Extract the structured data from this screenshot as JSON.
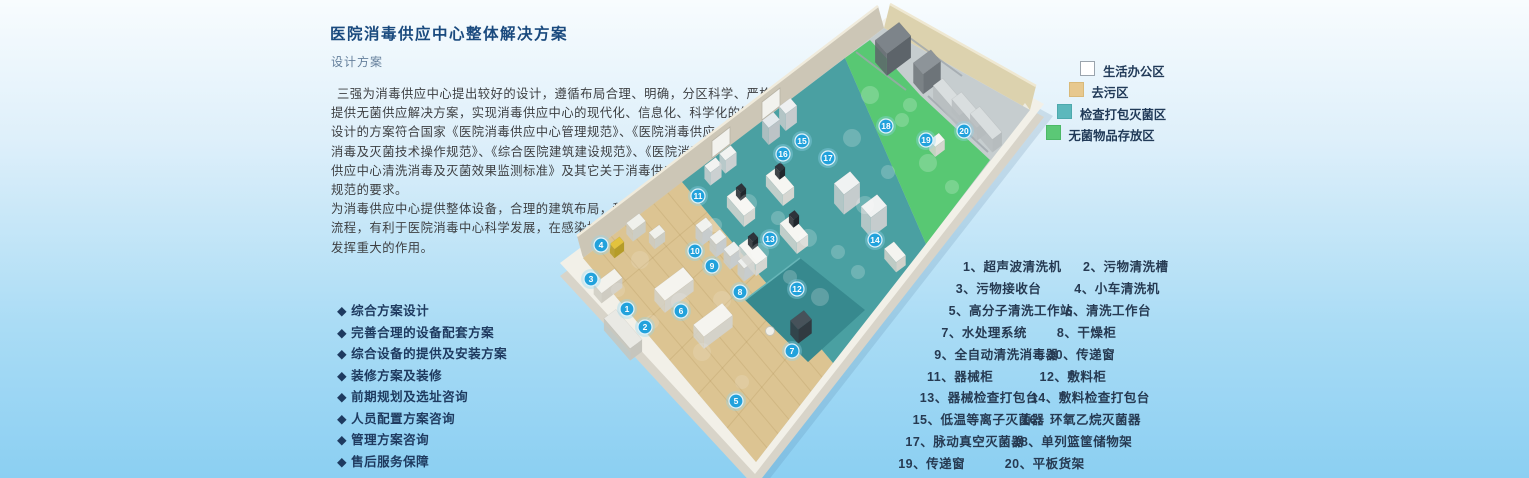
{
  "header": {
    "title": "医院消毒供应中心整体解决方案",
    "subtitle": "设计方案"
  },
  "description": {
    "lines": [
      "三强为消毒供应中心提出较好的设计，遵循布局合理、明确，分区科学、严格的原则，为医院",
      "提供无菌供应解决方案，实现消毒供应中心的现代化、信息化、科学化的管理。",
      "设计的方案符合国家《医院消毒供应中心管理规范》、《医院消毒供应 中心清洗",
      "消毒及灭菌技术操作规范》、《综合医院建筑建设规范》、《医院消毒",
      "供应中心清洗消毒及灭菌效果监测标准》及其它关于消毒供应中心",
      "规范的要求。",
      "为消毒供应中心提供整体设备，合理的建筑布局，科学的工作",
      "流程，有利于医院消毒中心科学发展，在感染控制领域",
      "发挥重大的作用。"
    ]
  },
  "services": {
    "bullet": "◆",
    "items": [
      "综合方案设计",
      "完善合理的设备配套方案",
      "综合设备的提供及安装方案",
      "装修方案及装修",
      "前期规划及选址咨询",
      "人员配置方案咨询",
      "管理方案咨询",
      "售后服务保障"
    ]
  },
  "legend": {
    "items": [
      {
        "label": "生活办公区",
        "color": "#ffffff",
        "border": "#9aa4ad"
      },
      {
        "label": "去污区",
        "color": "#e7c88e",
        "border": "#d9b979"
      },
      {
        "label": "检查打包灭菌区",
        "color": "#5cb8bc",
        "border": "#4da9ad"
      },
      {
        "label": "无菌物品存放区",
        "color": "#5bc876",
        "border": "#4cb967"
      }
    ]
  },
  "equipment": {
    "rows": [
      [
        {
          "no": "1",
          "name": "超声波清洗机"
        },
        {
          "no": "2",
          "name": "污物清洗槽"
        }
      ],
      [
        {
          "no": "3",
          "name": "污物接收台"
        },
        {
          "no": "4",
          "name": "小车清洗机"
        }
      ],
      [
        {
          "no": "5",
          "name": "高分子清洗工作站"
        },
        {
          "no": "6",
          "name": "清洗工作台"
        }
      ],
      [
        {
          "no": "7",
          "name": "水处理系统"
        },
        {
          "no": "8",
          "name": "干燥柜"
        }
      ],
      [
        {
          "no": "9",
          "name": "全自动清洗消毒器"
        },
        {
          "no": "10",
          "name": "传递窗"
        }
      ],
      [
        {
          "no": "11",
          "name": "器械柜"
        },
        {
          "no": "12",
          "name": "敷料柜"
        }
      ],
      [
        {
          "no": "13",
          "name": "器械检查打包台"
        },
        {
          "no": "14",
          "name": "敷料检查打包台"
        }
      ],
      [
        {
          "no": "15",
          "name": "低温等离子灭菌器"
        },
        {
          "no": "16",
          "name": "环氧乙烷灭菌器"
        }
      ],
      [
        {
          "no": "17",
          "name": "脉动真空灭菌器"
        },
        {
          "no": "18",
          "name": "单列篮筐储物架"
        }
      ],
      [
        {
          "no": "19",
          "name": "传递窗"
        },
        {
          "no": "20",
          "name": "平板货架"
        }
      ]
    ]
  },
  "floorplan": {
    "marker_color": "#22a2dc",
    "floor_base_color": "#c6cdcf",
    "zones": [
      {
        "name": "去污区",
        "color": "#dcc492",
        "points": "583,258 682,182 833,363 756,462"
      },
      {
        "name": "检查打包灭菌区",
        "color": "#4aa0a2",
        "points": "682,182 845,58 926,244 833,363"
      },
      {
        "name": "无菌物品存放区",
        "color": "#58c873",
        "points": "845,58 870,40 920,95 990,160 926,244"
      }
    ],
    "markers": [
      {
        "n": "1",
        "x": 627,
        "y": 309
      },
      {
        "n": "2",
        "x": 645,
        "y": 327
      },
      {
        "n": "3",
        "x": 591,
        "y": 279
      },
      {
        "n": "4",
        "x": 601,
        "y": 245
      },
      {
        "n": "5",
        "x": 736,
        "y": 401
      },
      {
        "n": "6",
        "x": 681,
        "y": 311
      },
      {
        "n": "7",
        "x": 792,
        "y": 351
      },
      {
        "n": "8",
        "x": 740,
        "y": 292
      },
      {
        "n": "9",
        "x": 712,
        "y": 266
      },
      {
        "n": "10",
        "x": 695,
        "y": 251
      },
      {
        "n": "11",
        "x": 698,
        "y": 196
      },
      {
        "n": "12",
        "x": 797,
        "y": 289
      },
      {
        "n": "13",
        "x": 770,
        "y": 239
      },
      {
        "n": "14",
        "x": 875,
        "y": 240
      },
      {
        "n": "15",
        "x": 802,
        "y": 141
      },
      {
        "n": "16",
        "x": 783,
        "y": 154
      },
      {
        "n": "17",
        "x": 828,
        "y": 158
      },
      {
        "n": "18",
        "x": 886,
        "y": 126
      },
      {
        "n": "19",
        "x": 926,
        "y": 140
      },
      {
        "n": "20",
        "x": 964,
        "y": 131
      }
    ]
  }
}
